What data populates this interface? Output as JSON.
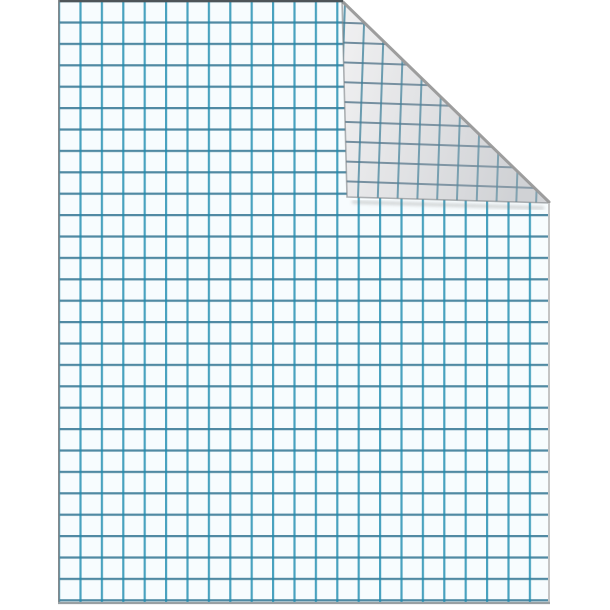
{
  "scene": {
    "description": "Blank sheet of blue quadrille graph paper with its top-right corner folded over, shown on a plain white background",
    "object": "graph paper sheet",
    "fold": "top-right corner folded down-left, showing gridded back side of the paper",
    "text_content": "none"
  },
  "grid": {
    "style": "square quadrille grid",
    "columns": 23,
    "rows": 28
  },
  "colors": {
    "background": "#ffffff",
    "paper": "#f7fcfe",
    "grid-line-h": "rgba(40,110,140,0.8)",
    "grid-line-v": "rgba(30,140,175,0.8)",
    "flap-paper": "#f1f1f2",
    "flap-line-h": "rgba(60,100,125,0.72)",
    "flap-line-v": "rgba(45,120,150,0.72)",
    "flap-shade": "rgba(168,172,178,0.45)",
    "edge-top": "#4e5559",
    "edge-left": "#82888c",
    "edge-right": "#c4c4c4",
    "edge-bottom": "#99a0a3",
    "crease": "#999999",
    "flap-edge": "rgba(125,130,134,0.6)",
    "shadow": "rgba(100,100,100,0.45)"
  }
}
